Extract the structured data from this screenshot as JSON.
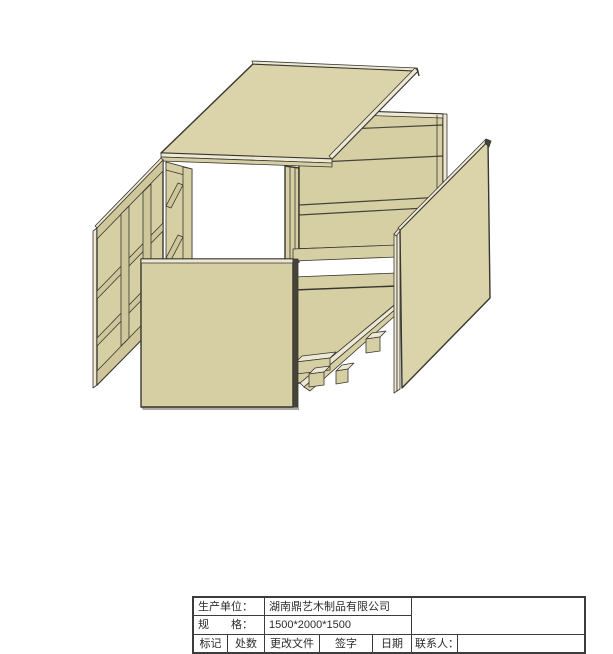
{
  "title_block": {
    "producer_label": "生产单位：",
    "producer_value": "湖南鼎艺木制品有限公司",
    "spec_label": "规　　格：",
    "spec_value": "1500*2000*1500",
    "col_mark": "标记",
    "col_count": "处数",
    "col_change_file": "更改文件",
    "col_signature": "签字",
    "col_date": "日期",
    "contact_label": "联系人：",
    "contact_value": "",
    "notes_value": ""
  },
  "drawing": {
    "description": "Exploded isometric view of a wooden packing crate: lid, left framed side panel, front panel, right side panel, plank back walls and pallet floor with skid blocks",
    "parts": [
      "top-panel",
      "left-side-panel",
      "front-panel",
      "right-side-panel",
      "back-left-wall",
      "back-right-wall",
      "floor-pallet",
      "skid-blocks"
    ],
    "colors": {
      "face": "#d6cfa4",
      "face-light": "#dbd4ab",
      "edge": "#ece8d4",
      "rail": "#cfc79b",
      "edge-dark": "#45433a",
      "outline": "#38362e",
      "shadow": "#a9a9a2",
      "background": "#ffffff",
      "table-border": "#3c3c3c",
      "text": "#2b2b2b"
    }
  }
}
